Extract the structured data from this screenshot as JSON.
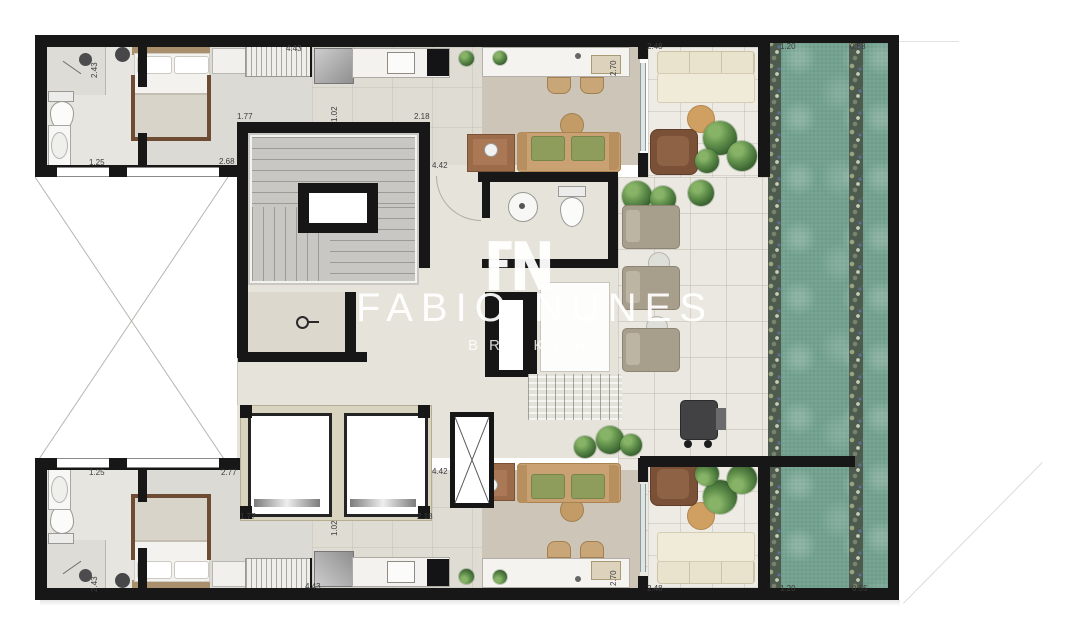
{
  "watermark": {
    "brand_word1": "FABIO",
    "brand_word2": "NUNES",
    "brand_sub": "BROKER",
    "monogram": "FN"
  },
  "dimension_labels": [
    {
      "text": "2.43",
      "x": 90,
      "y": 78,
      "rot": -90
    },
    {
      "text": "4.43",
      "x": 286,
      "y": 44,
      "rot": 0
    },
    {
      "text": "1.77",
      "x": 237,
      "y": 112,
      "rot": 0
    },
    {
      "text": "1.02",
      "x": 330,
      "y": 122,
      "rot": -90
    },
    {
      "text": "2.18",
      "x": 414,
      "y": 112,
      "rot": 0
    },
    {
      "text": "1.25",
      "x": 89,
      "y": 158,
      "rot": 0
    },
    {
      "text": "2.68",
      "x": 219,
      "y": 157,
      "rot": 0
    },
    {
      "text": "4.42",
      "x": 432,
      "y": 161,
      "rot": 0
    },
    {
      "text": "2.70",
      "x": 609,
      "y": 76,
      "rot": -90
    },
    {
      "text": "2.48",
      "x": 647,
      "y": 42,
      "rot": 0
    },
    {
      "text": "1.20",
      "x": 780,
      "y": 42,
      "rot": 0
    },
    {
      "text": "0.58",
      "x": 850,
      "y": 42,
      "rot": 0
    },
    {
      "text": "1.25",
      "x": 89,
      "y": 468,
      "rot": 0
    },
    {
      "text": "2.77",
      "x": 221,
      "y": 468,
      "rot": 0
    },
    {
      "text": "4.42",
      "x": 432,
      "y": 467,
      "rot": 0
    },
    {
      "text": "1.77",
      "x": 240,
      "y": 512,
      "rot": 0
    },
    {
      "text": "2.18",
      "x": 417,
      "y": 512,
      "rot": 0
    },
    {
      "text": "1.02",
      "x": 330,
      "y": 536,
      "rot": -90
    },
    {
      "text": "2.43",
      "x": 90,
      "y": 592,
      "rot": -90
    },
    {
      "text": "2.70",
      "x": 609,
      "y": 586,
      "rot": -90
    },
    {
      "text": "4.43",
      "x": 305,
      "y": 582,
      "rot": 0
    },
    {
      "text": "2.48",
      "x": 647,
      "y": 584,
      "rot": 0
    },
    {
      "text": "1.20",
      "x": 780,
      "y": 584,
      "rot": 0
    },
    {
      "text": "0.55",
      "x": 852,
      "y": 584,
      "rot": 0
    }
  ],
  "colors": {
    "wall": "#171717",
    "pool_water": "#7aa795",
    "pebble_border": "#4d5a4e",
    "pool_deck": "#eae8e0",
    "floor_bedroom": "#dcdad4",
    "floor_kitchen": "#dfdcd4",
    "living_rug": "#cdc6b8",
    "floor_bathroom": "#e7e5e0",
    "stair_core": "#c8c7c3",
    "terrace": "#edebe4",
    "sofa_tan": "#c9a173",
    "cushion_green": "#8e9c5c",
    "outdoor_sofa_cream": "#f0ead8",
    "lounger_taupe": "#a79e8c",
    "armchair_brown": "#7a5136",
    "plant_green": "#4e7b40",
    "elevator_frame": "#d9d4c0"
  }
}
